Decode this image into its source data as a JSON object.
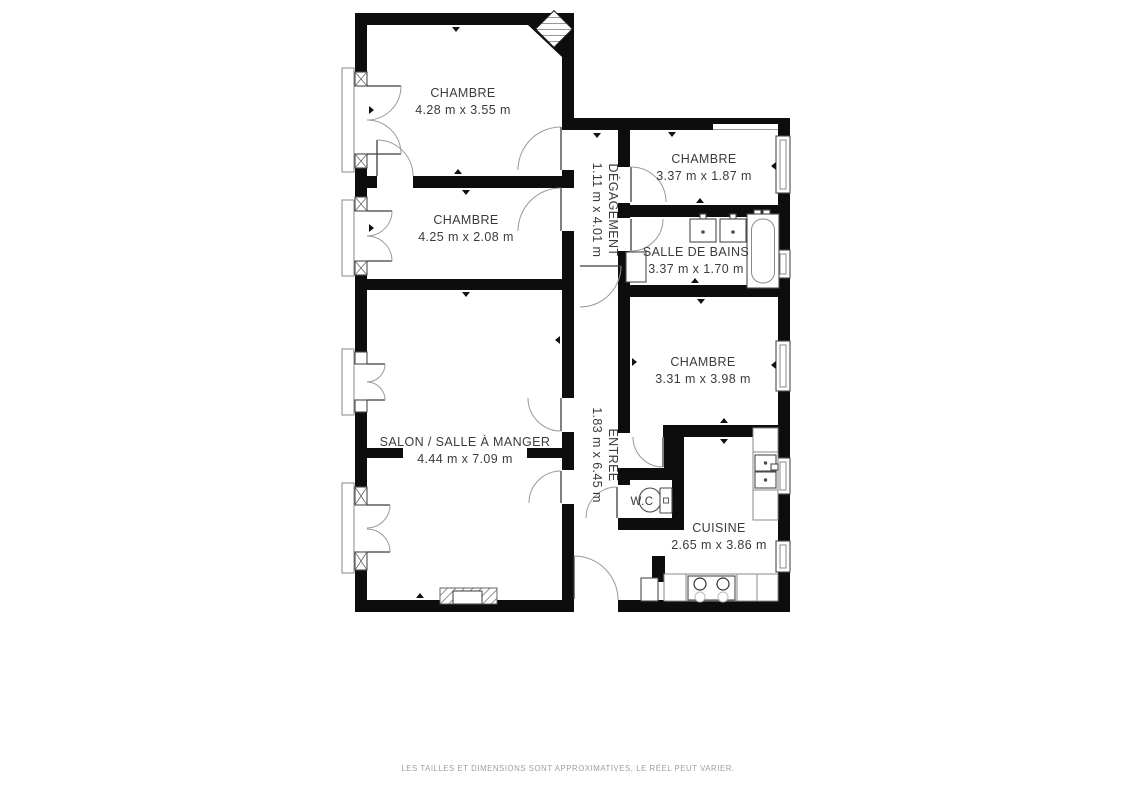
{
  "plan": {
    "rooms": [
      {
        "id": "chambre-1",
        "name": "CHAMBRE",
        "dims": "4.28 m x 3.55 m"
      },
      {
        "id": "chambre-2",
        "name": "CHAMBRE",
        "dims": "4.25 m x 2.08 m"
      },
      {
        "id": "chambre-3",
        "name": "CHAMBRE",
        "dims": "3.37 m x 1.87 m"
      },
      {
        "id": "degagement",
        "name": "DÉGAGEMENT",
        "dims": "1.11 m x 4.01 m"
      },
      {
        "id": "salle-de-bains",
        "name": "SALLE DE BAINS",
        "dims": "3.37 m x 1.70 m"
      },
      {
        "id": "chambre-4",
        "name": "CHAMBRE",
        "dims": "3.31 m x 3.98 m"
      },
      {
        "id": "salon",
        "name": "SALON / SALLE À MANGER",
        "dims": "4.44 m x 7.09 m"
      },
      {
        "id": "entree",
        "name": "ENTRÉE",
        "dims": "1.83 m x 6.45 m"
      },
      {
        "id": "wc",
        "name": "W.C",
        "dims": ""
      },
      {
        "id": "cuisine",
        "name": "CUISINE",
        "dims": "2.65 m x 3.86 m"
      }
    ],
    "footer": "LES TAILLES ET DIMENSIONS SONT APPROXIMATIVES, LE RÉEL PEUT VARIER.",
    "colors": {
      "wall": "#0d0d0d",
      "line": "#4a4a4a",
      "swing_line": "#9a9a9a",
      "text": "#3b3b3b",
      "footer_text": "#9e9e9e",
      "background": "#ffffff"
    }
  }
}
